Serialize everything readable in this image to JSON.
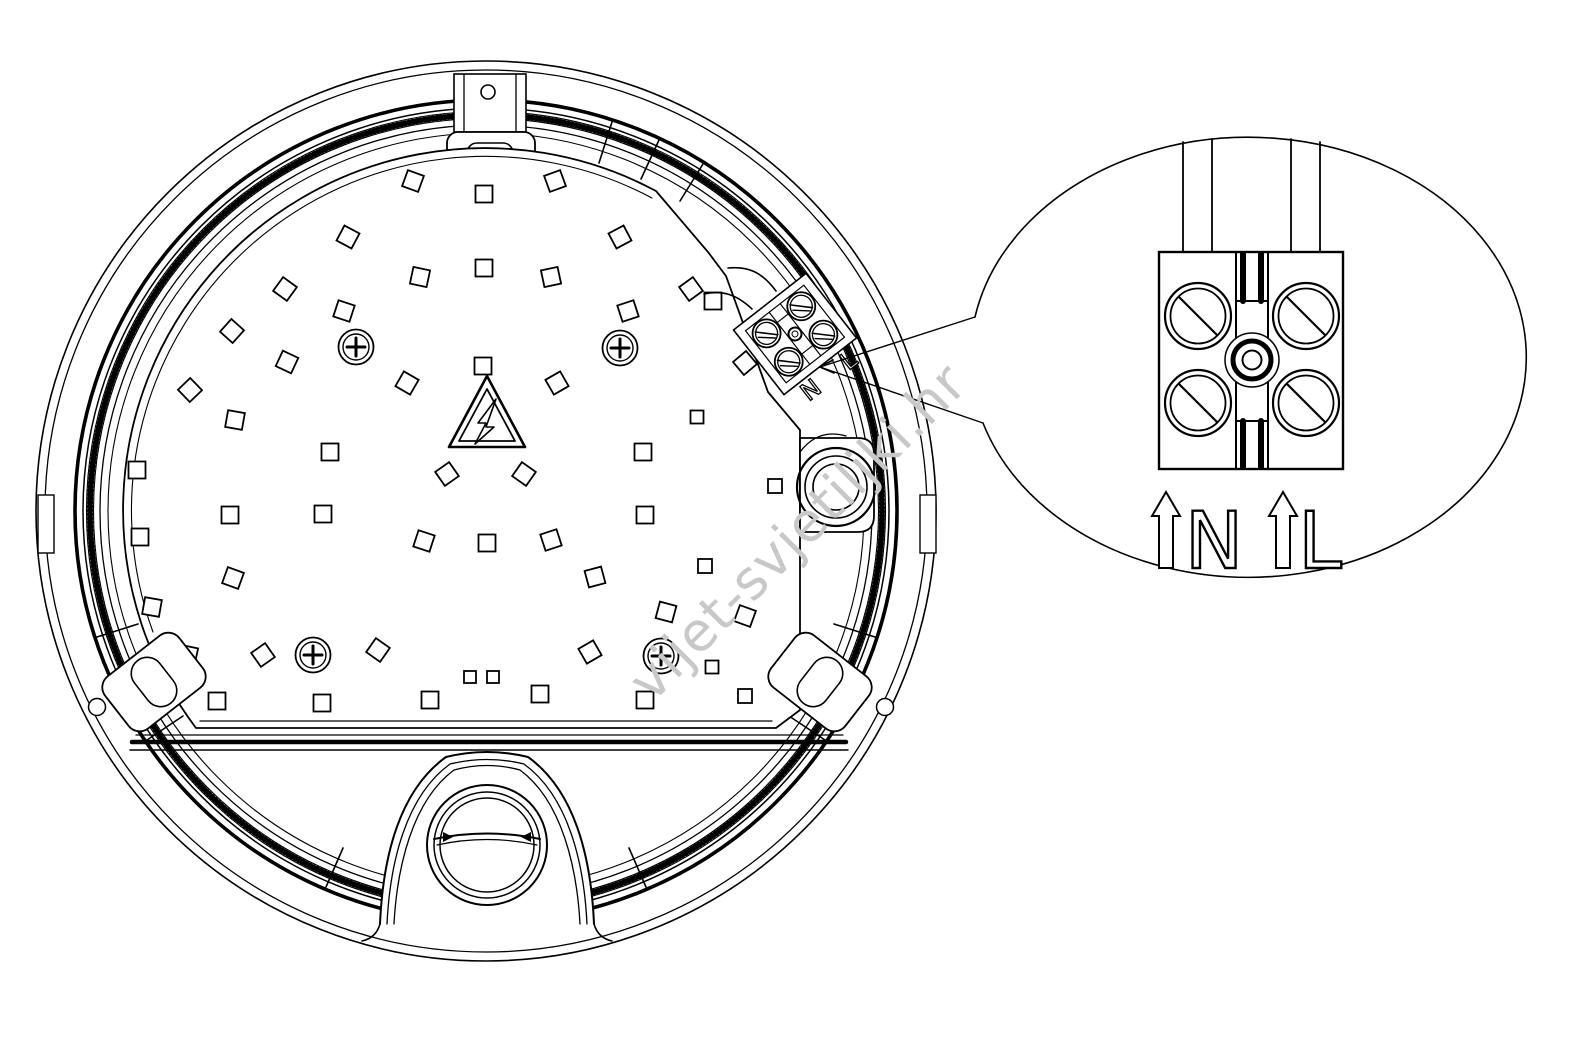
{
  "diagram": {
    "watermark": "vijet-svjetiljki.hr",
    "detail_view": {
      "label_n": "N",
      "label_l": "L"
    },
    "fixture": {
      "terminal_label_n": "N",
      "terminal_label_l": "L"
    },
    "colors": {
      "line": "#000000",
      "background": "#ffffff",
      "watermark": "#c8c8c8"
    },
    "led_squares": [
      [
        413,
        181,
        20
      ],
      [
        484,
        194,
        0
      ],
      [
        555,
        181,
        -20
      ],
      [
        348,
        237,
        28
      ],
      [
        620,
        237,
        -28
      ],
      [
        285,
        289,
        36
      ],
      [
        420,
        277,
        12
      ],
      [
        484,
        268,
        0
      ],
      [
        551,
        277,
        -12
      ],
      [
        691,
        289,
        -36
      ],
      [
        232,
        331,
        42
      ],
      [
        344,
        311,
        18
      ],
      [
        628,
        311,
        -18
      ],
      [
        713,
        301,
        0
      ],
      [
        190,
        390,
        46
      ],
      [
        287,
        362,
        25
      ],
      [
        745,
        363,
        -40
      ],
      [
        137,
        470,
        0
      ],
      [
        407,
        383,
        30
      ],
      [
        483,
        366,
        0
      ],
      [
        557,
        383,
        -30
      ],
      [
        697,
        417,
        0,
        13
      ],
      [
        235,
        420,
        10
      ],
      [
        140,
        537,
        0
      ],
      [
        447,
        474,
        -35
      ],
      [
        524,
        474,
        35
      ],
      [
        330,
        452,
        0
      ],
      [
        643,
        452,
        0
      ],
      [
        775,
        486,
        0,
        14
      ],
      [
        230,
        515,
        0
      ],
      [
        323,
        514,
        0
      ],
      [
        152,
        607,
        10
      ],
      [
        424,
        541,
        18
      ],
      [
        487,
        543,
        0
      ],
      [
        551,
        540,
        -18
      ],
      [
        645,
        515,
        0
      ],
      [
        705,
        566,
        0,
        14
      ],
      [
        233,
        578,
        20
      ],
      [
        595,
        577,
        -15
      ],
      [
        378,
        650,
        35
      ],
      [
        590,
        652,
        -30
      ],
      [
        666,
        612,
        15
      ],
      [
        745,
        616,
        20
      ],
      [
        188,
        655,
        12
      ],
      [
        263,
        655,
        -35
      ],
      [
        470,
        677,
        0,
        12
      ],
      [
        493,
        677,
        0,
        12
      ],
      [
        217,
        701,
        0
      ],
      [
        322,
        703,
        0
      ],
      [
        430,
        700,
        0
      ],
      [
        540,
        694,
        0
      ],
      [
        645,
        700,
        0
      ],
      [
        745,
        696,
        0,
        14
      ],
      [
        712,
        667,
        0,
        13
      ]
    ]
  }
}
